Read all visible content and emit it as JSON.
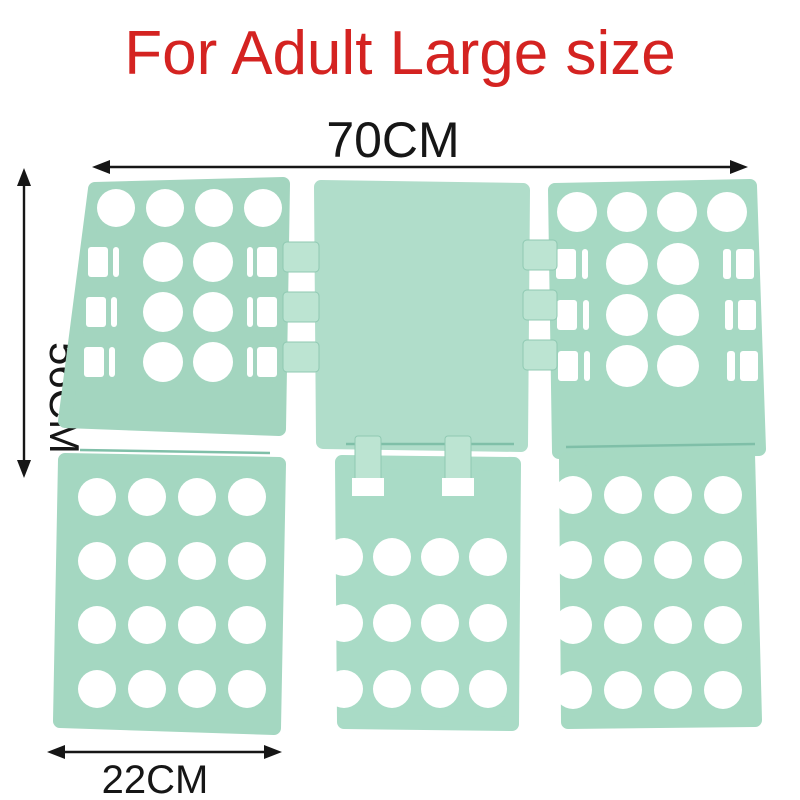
{
  "title": {
    "text": "For Adult Large size",
    "color": "#d42321"
  },
  "dimensions": {
    "width_label": "70CM",
    "height_label": "56CM",
    "bottom_width_label": "22CM"
  },
  "board": {
    "description": "Mint green clothes folding board, six hinged panels with circular fold holes",
    "colors": {
      "hole": "#ffffff",
      "tab": "#bce4d2",
      "tab_edge": "#8fc9b2",
      "rod": "#7fbfa8"
    },
    "panels": [
      {
        "name": "panel-top-left",
        "color": "#a3d5bf",
        "points": [
          [
            95,
            189
          ],
          [
            283,
            184
          ],
          [
            279,
            429
          ],
          [
            65,
            421
          ]
        ],
        "hole_grids": [
          {
            "x0": 116,
            "y0": 208,
            "dx": 49,
            "dy": 0,
            "cols": 4,
            "rows": 1,
            "r": 19
          },
          {
            "x0": 163,
            "y0": 262,
            "dx": 50,
            "dy": 50,
            "cols": 2,
            "rows": 3,
            "r": 20
          }
        ],
        "slot_rects": [
          [
            88,
            247,
            20,
            30
          ],
          [
            113,
            247,
            6,
            30
          ],
          [
            86,
            297,
            20,
            30
          ],
          [
            111,
            297,
            6,
            30
          ],
          [
            84,
            347,
            20,
            30
          ],
          [
            109,
            347,
            6,
            30
          ],
          [
            247,
            247,
            6,
            30
          ],
          [
            257,
            247,
            20,
            30
          ],
          [
            247,
            297,
            6,
            30
          ],
          [
            257,
            297,
            20,
            30
          ],
          [
            247,
            347,
            6,
            30
          ],
          [
            257,
            347,
            20,
            30
          ]
        ]
      },
      {
        "name": "panel-top-center",
        "color": "#b0ddca",
        "points": [
          [
            321,
            187
          ],
          [
            523,
            190
          ],
          [
            521,
            445
          ],
          [
            323,
            442
          ]
        ],
        "hole_grids": [],
        "slot_rects": []
      },
      {
        "name": "panel-top-right",
        "color": "#a6d9c3",
        "points": [
          [
            555,
            190
          ],
          [
            750,
            186
          ],
          [
            759,
            449
          ],
          [
            559,
            452
          ]
        ],
        "hole_grids": [
          {
            "x0": 577,
            "y0": 212,
            "dx": 50,
            "dy": 0,
            "cols": 4,
            "rows": 1,
            "r": 20
          },
          {
            "x0": 627,
            "y0": 264,
            "dx": 51,
            "dy": 51,
            "cols": 2,
            "rows": 3,
            "r": 21
          }
        ],
        "slot_rects": [
          [
            556,
            249,
            20,
            30
          ],
          [
            582,
            249,
            6,
            30
          ],
          [
            557,
            300,
            20,
            30
          ],
          [
            583,
            300,
            6,
            30
          ],
          [
            558,
            351,
            20,
            30
          ],
          [
            584,
            351,
            6,
            30
          ],
          [
            723,
            249,
            8,
            30
          ],
          [
            736,
            249,
            18,
            30
          ],
          [
            725,
            300,
            8,
            30
          ],
          [
            738,
            300,
            18,
            30
          ],
          [
            727,
            351,
            8,
            30
          ],
          [
            740,
            351,
            18,
            30
          ]
        ]
      },
      {
        "name": "panel-bottom-left",
        "color": "#a4d7c1",
        "points": [
          [
            65,
            460
          ],
          [
            279,
            464
          ],
          [
            274,
            728
          ],
          [
            60,
            721
          ]
        ],
        "hole_grids": [
          {
            "x0": 97,
            "y0": 497,
            "dx": 50,
            "dy": 64,
            "cols": 4,
            "rows": 4,
            "r": 19
          }
        ],
        "slot_rects": []
      },
      {
        "name": "panel-bottom-center",
        "color": "#a9dbc6",
        "points": [
          [
            342,
            462
          ],
          [
            514,
            464
          ],
          [
            512,
            724
          ],
          [
            344,
            722
          ]
        ],
        "hole_grids": [
          {
            "x0": 344,
            "y0": 557,
            "dx": 48,
            "dy": 66,
            "cols": 4,
            "rows": 3,
            "r": 19
          }
        ],
        "slot_rects": []
      },
      {
        "name": "panel-bottom-right",
        "color": "#a6d9c2",
        "points": [
          [
            566,
            459
          ],
          [
            748,
            454
          ],
          [
            755,
            720
          ],
          [
            568,
            722
          ]
        ],
        "hole_grids": [
          {
            "x0": 573,
            "y0": 495,
            "dx": 50,
            "dy": 65,
            "cols": 4,
            "rows": 4,
            "r": 19
          }
        ],
        "slot_rects": []
      }
    ],
    "rods": [
      [
        80,
        450,
        270,
        453
      ],
      [
        346,
        444,
        514,
        444
      ],
      [
        566,
        447,
        755,
        444
      ]
    ],
    "tabs": [
      [
        283,
        242,
        36,
        30
      ],
      [
        283,
        292,
        36,
        30
      ],
      [
        283,
        342,
        36,
        30
      ],
      [
        523,
        240,
        34,
        30
      ],
      [
        523,
        290,
        34,
        30
      ],
      [
        523,
        340,
        34,
        30
      ]
    ],
    "clips": [
      [
        355,
        436,
        26,
        52
      ],
      [
        445,
        436,
        26,
        52
      ]
    ],
    "clip_windows": [
      [
        352,
        478,
        32,
        18
      ],
      [
        442,
        478,
        32,
        18
      ]
    ]
  }
}
